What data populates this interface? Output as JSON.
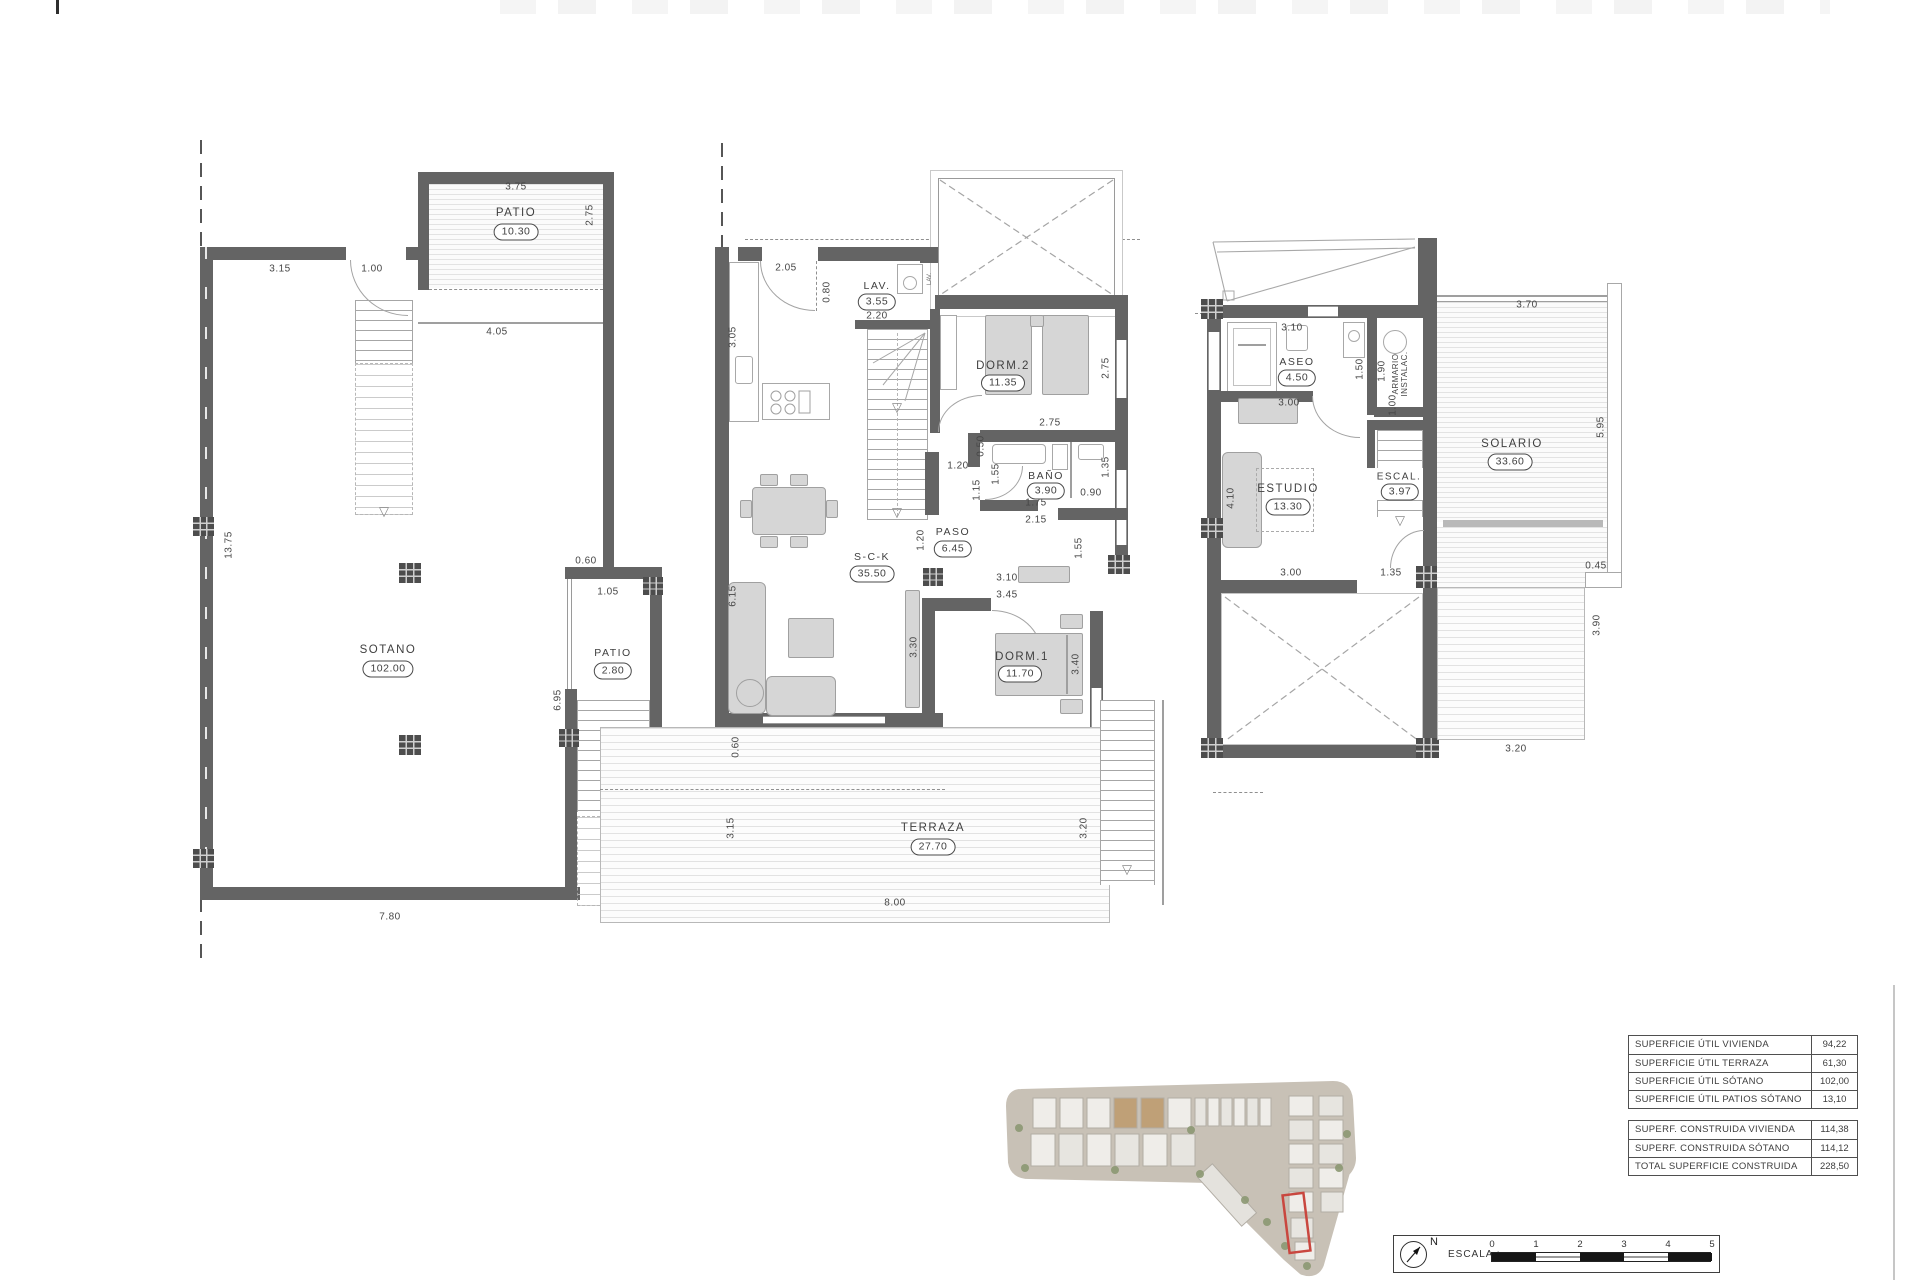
{
  "icons": {
    "down_arrow": "▽",
    "north": "N"
  },
  "plans": {
    "basement": {
      "patio_top": {
        "name": "PATIO",
        "area": "10.30"
      },
      "sotano": {
        "name": "SOTANO",
        "area": "102.00"
      },
      "patio_side": {
        "name": "PATIO",
        "area": "2.80"
      },
      "dims": {
        "b1": "3.75",
        "b2": "2.75",
        "b3": "3.15",
        "b4": "1.00",
        "b5": "4.05",
        "b6": "13.75",
        "b7": "0.60",
        "b8": "1.05",
        "b9": "6.95",
        "b10": "7.80"
      }
    },
    "ground": {
      "lav": {
        "name": "LAV.",
        "area": "3.55"
      },
      "lav_appliance": "LAV.",
      "dorm2": {
        "name": "DORM.2",
        "area": "11.35"
      },
      "bano": {
        "name": "BAÑO",
        "area": "3.90"
      },
      "paso": {
        "name": "PASO",
        "area": "6.45"
      },
      "sck": {
        "name": "S-C-K",
        "area": "35.50"
      },
      "dorm1": {
        "name": "DORM.1",
        "area": "11.70"
      },
      "terraza": {
        "name": "TERRAZA",
        "area": "27.70"
      },
      "dims": {
        "g1": "2.05",
        "g2": "3.05",
        "g3": "0.80",
        "g4": "2.20",
        "g5": "2.75",
        "g6": "2.75",
        "g7": "1.20",
        "g8": "1.20",
        "g9": "1.15",
        "g10": "1.55",
        "g11": "0.50",
        "g12": "1.35",
        "g13": "0.90",
        "g14": "1.75",
        "g15": "2.15",
        "g16": "1.55",
        "g17": "3.10",
        "g18": "3.45",
        "g19": "3.30",
        "g20": "3.40",
        "g21": "6.15",
        "g22": "0.60",
        "g23": "3.15",
        "g24": "3.20",
        "g25": "8.00"
      }
    },
    "upper": {
      "aseo": {
        "name": "ASEO",
        "area": "4.50"
      },
      "armario_line1": "ARMARIO",
      "armario_line2": "INSTALAC.",
      "estudio": {
        "name": "ESTUDIO",
        "area": "13.30"
      },
      "escal": {
        "name": "ESCAL.",
        "area": "3.97"
      },
      "solario": {
        "name": "SOLARIO",
        "area": "33.60"
      },
      "dims": {
        "u1": "3.10",
        "u2": "1.50",
        "u3": "1.90",
        "u4": "1.00",
        "u5": "3.00",
        "u6": "4.10",
        "u7": "3.00",
        "u8": "1.35",
        "u9": "3.70",
        "u10": "5.95",
        "u11": "0.45",
        "u12": "3.90",
        "u13": "3.20"
      }
    }
  },
  "summary": {
    "util": [
      {
        "label": "SUPERFICIE ÚTIL VIVIENDA",
        "value": "94,22"
      },
      {
        "label": "SUPERFICIE ÚTIL TERRAZA",
        "value": "61,30"
      },
      {
        "label": "SUPERFICIE ÚTIL SÓTANO",
        "value": "102,00"
      },
      {
        "label": "SUPERFICIE ÚTIL PATIOS SÓTANO",
        "value": "13,10"
      }
    ],
    "construida": [
      {
        "label": "SUPERF. CONSTRUIDA VIVIENDA",
        "value": "114,38"
      },
      {
        "label": "SUPERF. CONSTRUIDA SÓTANO",
        "value": "114,12"
      },
      {
        "label": "TOTAL SUPERFICIE CONSTRUIDA",
        "value": "228,50"
      }
    ]
  },
  "scalebar": {
    "label": "ESCALA :",
    "ticks": [
      "0",
      "1",
      "2",
      "3",
      "4",
      "5"
    ]
  }
}
